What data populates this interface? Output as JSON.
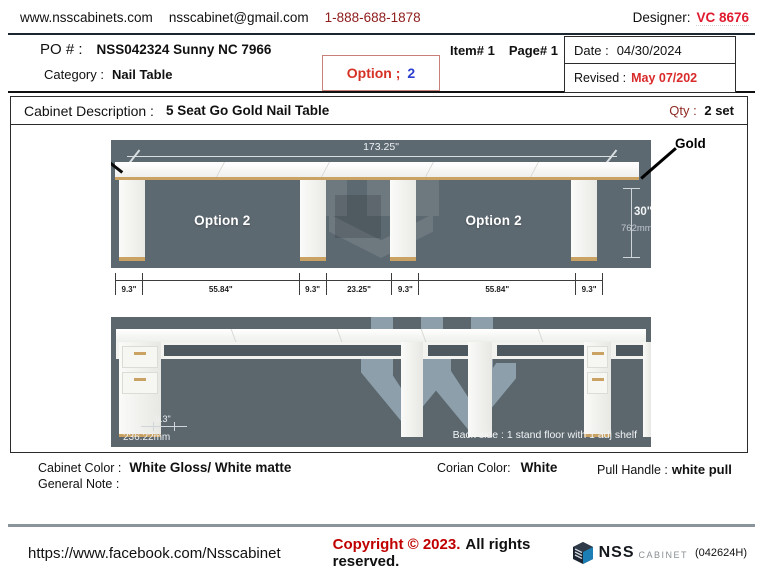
{
  "header": {
    "website": "www.nsscabinets.com",
    "email": "nsscabinet@gmail.com",
    "phone": "1-888-688-1878",
    "designer_label": "Designer:",
    "designer_value": "VC 8676"
  },
  "order": {
    "po_label": "PO # :",
    "po_value": "NSS042324 Sunny NC 7966",
    "item": "Item# 1",
    "page": "Page# 1",
    "category_label": "Category :",
    "category_value": "Nail Table",
    "option_label": "Option ;",
    "option_value": "2",
    "date_label": "Date :",
    "date_value": "04/30/2024",
    "revised_label": "Revised :",
    "revised_value": "May 07/202"
  },
  "description": {
    "label": "Cabinet Description :",
    "value": "5 Seat Go Gold Nail Table",
    "qty_label": "Qty :",
    "qty_value": "2 set"
  },
  "front_view": {
    "overall_width": "173.25\"",
    "gold_label": "Gold",
    "height_in": "30\"",
    "height_mm": "762mm",
    "slots": [
      {
        "type": "pedestal",
        "units": 9.3
      },
      {
        "type": "opening",
        "units": 55.84,
        "label": "Option 2"
      },
      {
        "type": "pedestal",
        "units": 9.3
      },
      {
        "type": "center",
        "units": 23.25
      },
      {
        "type": "pedestal",
        "units": 9.3
      },
      {
        "type": "opening",
        "units": 55.84,
        "label": "Option 2"
      },
      {
        "type": "pedestal",
        "units": 9.3
      }
    ],
    "dim_segments": [
      "9.3\"",
      "55.84\"",
      "9.3\"",
      "23.25\"",
      "9.3\"",
      "55.84\"",
      "9.3\""
    ]
  },
  "back_view": {
    "depth_in": "9.3\"",
    "depth_mm": "236.22mm",
    "note": "Back side : 1 stand floor with 1 adj shelf"
  },
  "notes": {
    "cabinet_color_label": "Cabinet Color :",
    "cabinet_color_value": "White Gloss/ White matte",
    "corian_label": "Corian Color:",
    "corian_value": "White",
    "pull_label": "Pull Handle :",
    "pull_value": "white pull",
    "general_note_label": "General Note :"
  },
  "footer": {
    "facebook": "https://www.facebook.com/Nsscabinet",
    "copyright_red": "Copyright © 2023.",
    "copyright_black": "All rights reserved.",
    "logo_text": "NSS",
    "logo_sub": "CABINET",
    "code": "(042624H)"
  },
  "colors": {
    "accent_red": "#d63125",
    "dark_red": "#8e1b1b",
    "designer_red": "#e01a2e",
    "option_blue": "#2b3fd0",
    "gold": "#caa264",
    "render_bg_front": "#5d6971",
    "render_bg_back": "#5b666d",
    "watermark_blue": "#bdd9e8",
    "footer_rule": "#8a949b"
  }
}
